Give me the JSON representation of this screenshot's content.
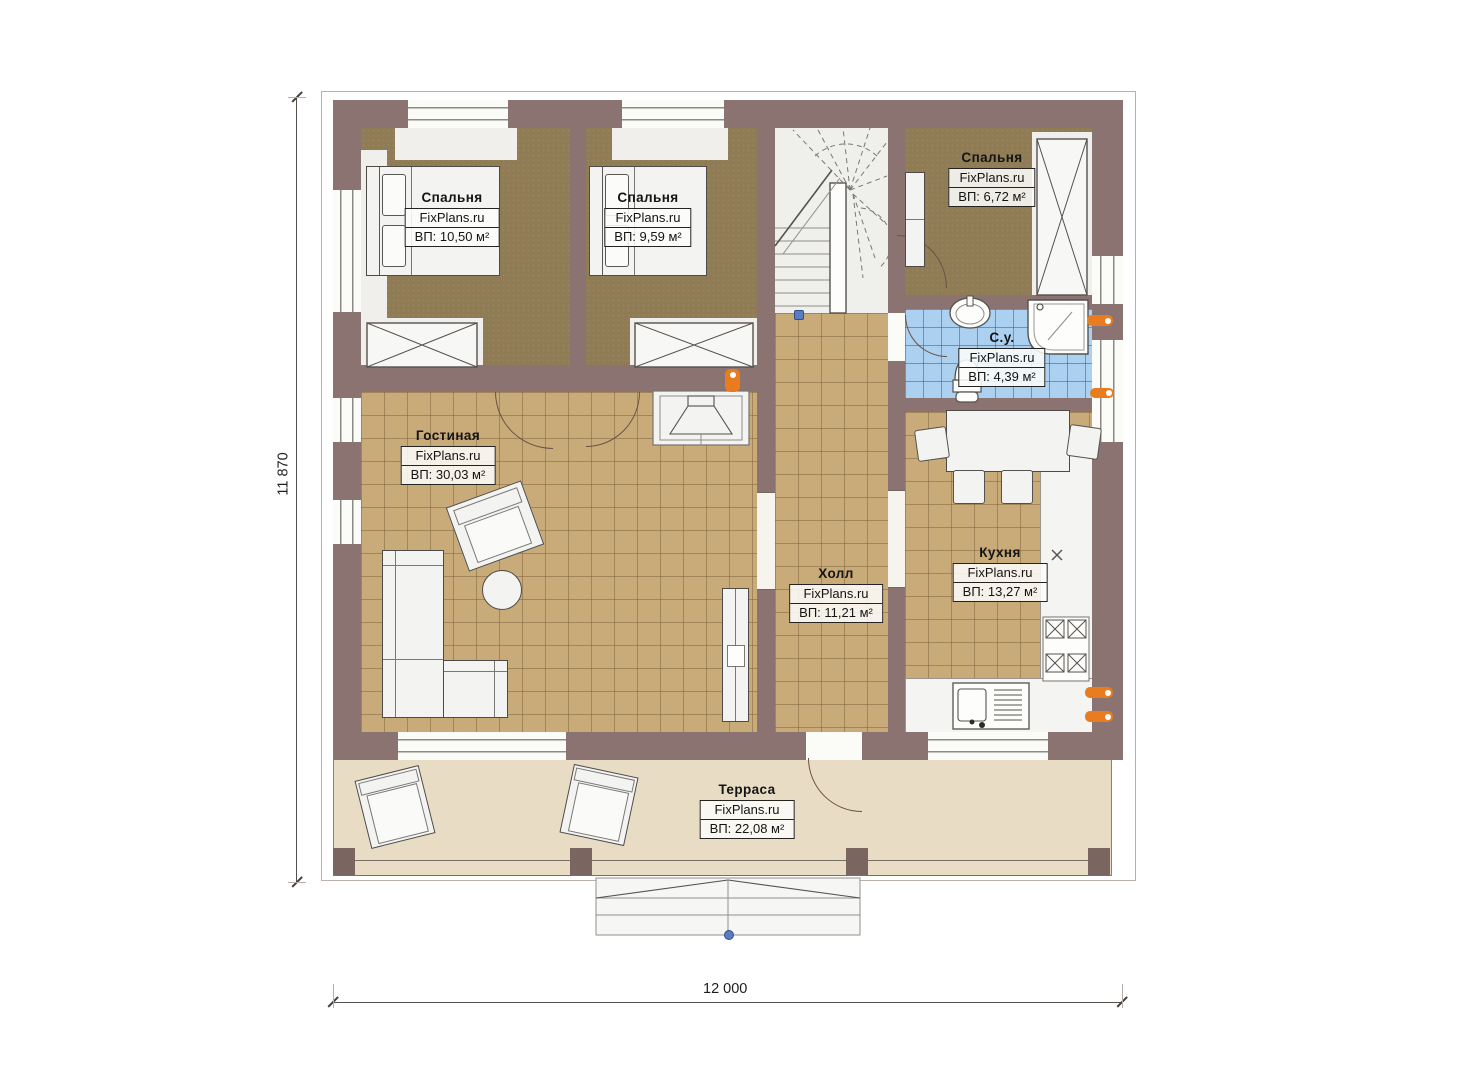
{
  "brand": "FixPlans.ru",
  "rooms": {
    "bedroom1": {
      "name": "Спальня",
      "area": "ВП: 10,50 м²"
    },
    "bedroom2": {
      "name": "Спальня",
      "area": "ВП: 9,59 м²"
    },
    "bedroom3": {
      "name": "Спальня",
      "area": "ВП: 6,72 м²"
    },
    "bathroom": {
      "name": "С.у.",
      "area": "ВП: 4,39 м²"
    },
    "living": {
      "name": "Гостиная",
      "area": "ВП: 30,03 м²"
    },
    "hall": {
      "name": "Холл",
      "area": "ВП: 11,21 м²"
    },
    "kitchen": {
      "name": "Кухня",
      "area": "ВП: 13,27 м²"
    },
    "terrace": {
      "name": "Терраса",
      "area": "ВП: 22,08 м²"
    }
  },
  "dimensions": {
    "vertical": "11 870",
    "horizontal": "12 000"
  },
  "colors": {
    "wall": "#8a7370",
    "wood_floor": "#8f7c55",
    "tile_floor": "#c9ab7a",
    "bath_tile": "#abd0f0",
    "terrace": "#e9dcc5",
    "accent_radiator": "#e87c1e"
  }
}
